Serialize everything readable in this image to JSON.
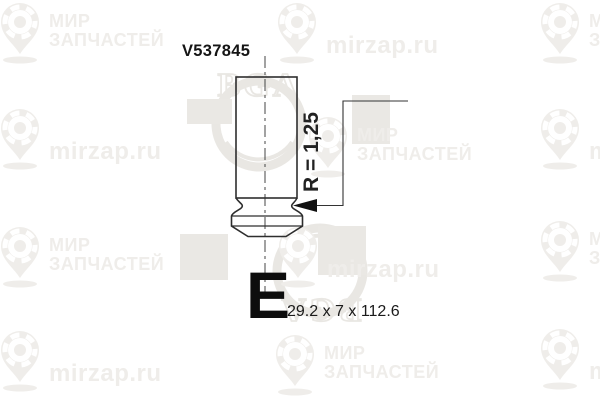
{
  "image": {
    "width": 600,
    "height": 400,
    "background": "#ffffff"
  },
  "drawing": {
    "part_number": "V537845",
    "radius_label": "R = 1,25",
    "valve_type_letter": "E",
    "dimensions_label": "29.2 x 7 x 112.6",
    "line_color": "#2e2e2e",
    "text_color": "#111111"
  },
  "watermarks": {
    "site_text": "mirzap.ru",
    "mir_line1": "МИР",
    "mir_line2": "ЗАПЧАСТЕЙ",
    "brand_text": "BGA",
    "color": "#efedea",
    "square_color": "#eae8e4",
    "bga_color": "#e9e7e3",
    "items": [
      {
        "x": 0,
        "y": 2,
        "variant": "mir"
      },
      {
        "x": 277,
        "y": 2,
        "variant": "zap"
      },
      {
        "x": 540,
        "y": 2,
        "variant": "mir"
      },
      {
        "x": 0,
        "y": 108,
        "variant": "zap"
      },
      {
        "x": 308,
        "y": 116,
        "variant": "mir"
      },
      {
        "x": 540,
        "y": 108,
        "variant": "zap"
      },
      {
        "x": 0,
        "y": 226,
        "variant": "mir"
      },
      {
        "x": 278,
        "y": 226,
        "variant": "zap"
      },
      {
        "x": 540,
        "y": 220,
        "variant": "mir"
      },
      {
        "x": 0,
        "y": 330,
        "variant": "zap"
      },
      {
        "x": 275,
        "y": 334,
        "variant": "mir"
      },
      {
        "x": 540,
        "y": 328,
        "variant": "zap"
      }
    ],
    "squares": [
      {
        "x": 187,
        "y": 99,
        "w": 45,
        "h": 25
      },
      {
        "x": 352,
        "y": 95,
        "w": 38,
        "h": 49
      },
      {
        "x": 180,
        "y": 234,
        "w": 48,
        "h": 46
      },
      {
        "x": 318,
        "y": 226,
        "w": 48,
        "h": 49
      }
    ],
    "bga_logos": [
      {
        "x": 204,
        "y": 62,
        "rotate": 0
      },
      {
        "x": 265,
        "y": 215,
        "rotate": 180
      }
    ]
  }
}
